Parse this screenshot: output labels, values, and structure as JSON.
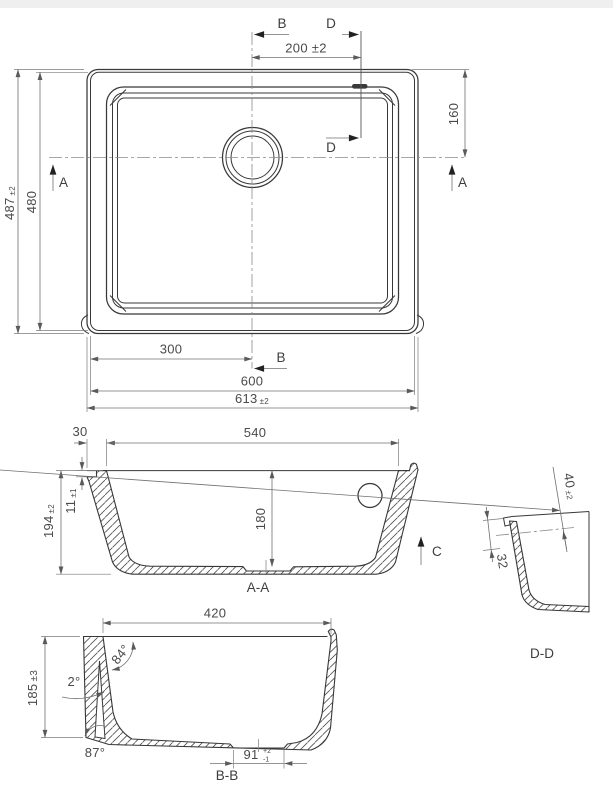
{
  "drawing": {
    "top_view": {
      "section_label_b": "B",
      "section_label_d": "D",
      "section_label_a": "A",
      "dim_drain_offset": "200 ±2",
      "dim_top_to_center": "160",
      "dim_height_overall": "487",
      "dim_height_overall_tol": "±2",
      "dim_height_inner": "480",
      "dim_center_offset": "300",
      "dim_width_inner": "600",
      "dim_width_overall": "613",
      "dim_width_overall_tol": "±2"
    },
    "section_aa": {
      "label": "A-A",
      "dim_rim_width": "30",
      "dim_bowl_width": "540",
      "dim_total_height": "194",
      "dim_total_height_tol": "±2",
      "dim_rim_step": "11",
      "dim_rim_step_tol": "±1",
      "dim_bowl_depth": "180",
      "view_arrow_c": "C"
    },
    "section_bb": {
      "label": "B-B",
      "dim_bowl_length": "420",
      "dim_height": "185",
      "dim_height_tol": "±3",
      "angle_inner_wall": "84°",
      "angle_draft": "2°",
      "angle_bottom": "87°",
      "dim_drain_flat": "91",
      "dim_drain_flat_tol_plus": "+2",
      "dim_drain_flat_tol_minus": "-1"
    },
    "detail_dd": {
      "label": "D-D",
      "dim_flange": "40",
      "dim_flange_tol": "±2",
      "dim_offset": "32"
    }
  }
}
